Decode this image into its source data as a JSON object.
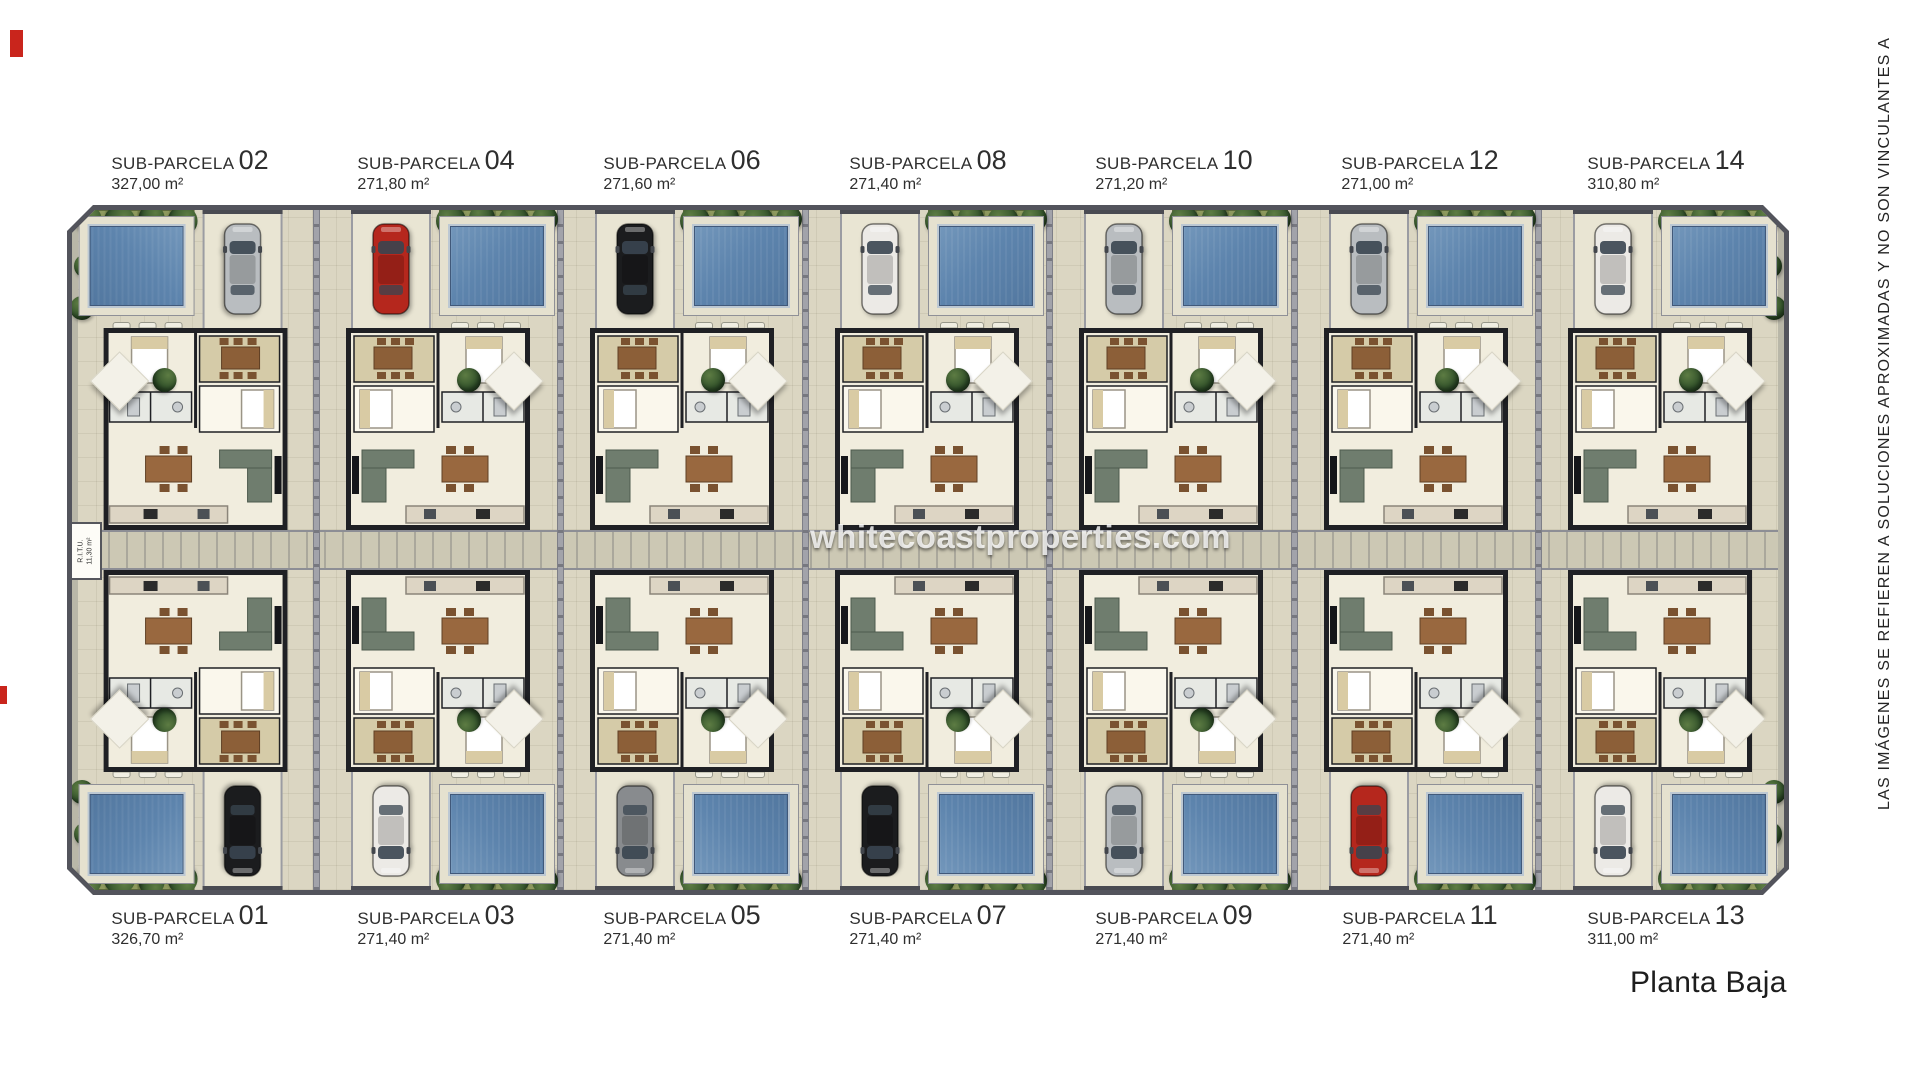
{
  "page": {
    "watermark": "whitecoastproperties.com",
    "plan_title": "Planta Baja",
    "side_disclaimer": "LAS IMÁGENES SE REFIEREN A SOLUCIONES APROXIMADAS Y NO SON VINCULANTES A",
    "ritu_label": "R.I.T.U.",
    "ritu_area": "11,30 m²"
  },
  "colors": {
    "ground": "#dbd6c2",
    "plan_border": "#53545c",
    "pool": "#5d84ad",
    "deck": "#e5e1cf",
    "tree": "#31512a",
    "villa_wall": "#1f2024",
    "villa_floor": "#f1edde",
    "lane": "#a2a3aa",
    "central_band": "#ccc8b4",
    "red_mark": "#c9251c",
    "car_colors": {
      "silver": "#b9bdc0",
      "red": "#b5271d",
      "black": "#1b1c1e",
      "white": "#eceae6",
      "gray": "#888b8e"
    }
  },
  "parcels": [
    {
      "label": "SUB-PARCELA",
      "number": "02",
      "area": "327,00 m²",
      "row": "top",
      "col": 0,
      "pool_side": "left",
      "car_color": "silver"
    },
    {
      "label": "SUB-PARCELA",
      "number": "04",
      "area": "271,80 m²",
      "row": "top",
      "col": 1,
      "pool_side": "right",
      "car_color": "red"
    },
    {
      "label": "SUB-PARCELA",
      "number": "06",
      "area": "271,60 m²",
      "row": "top",
      "col": 2,
      "pool_side": "right",
      "car_color": "black"
    },
    {
      "label": "SUB-PARCELA",
      "number": "08",
      "area": "271,40 m²",
      "row": "top",
      "col": 3,
      "pool_side": "right",
      "car_color": "white"
    },
    {
      "label": "SUB-PARCELA",
      "number": "10",
      "area": "271,20 m²",
      "row": "top",
      "col": 4,
      "pool_side": "right",
      "car_color": "silver"
    },
    {
      "label": "SUB-PARCELA",
      "number": "12",
      "area": "271,00 m²",
      "row": "top",
      "col": 5,
      "pool_side": "right",
      "car_color": "silver"
    },
    {
      "label": "SUB-PARCELA",
      "number": "14",
      "area": "310,80 m²",
      "row": "top",
      "col": 6,
      "pool_side": "right",
      "car_color": "white"
    },
    {
      "label": "SUB-PARCELA",
      "number": "01",
      "area": "326,70 m²",
      "row": "bottom",
      "col": 0,
      "pool_side": "left",
      "car_color": "black"
    },
    {
      "label": "SUB-PARCELA",
      "number": "03",
      "area": "271,40 m²",
      "row": "bottom",
      "col": 1,
      "pool_side": "right",
      "car_color": "white"
    },
    {
      "label": "SUB-PARCELA",
      "number": "05",
      "area": "271,40 m²",
      "row": "bottom",
      "col": 2,
      "pool_side": "right",
      "car_color": "gray"
    },
    {
      "label": "SUB-PARCELA",
      "number": "07",
      "area": "271,40 m²",
      "row": "bottom",
      "col": 3,
      "pool_side": "right",
      "car_color": "black"
    },
    {
      "label": "SUB-PARCELA",
      "number": "09",
      "area": "271,40 m²",
      "row": "bottom",
      "col": 4,
      "pool_side": "right",
      "car_color": "silver"
    },
    {
      "label": "SUB-PARCELA",
      "number": "11",
      "area": "271,40 m²",
      "row": "bottom",
      "col": 5,
      "pool_side": "right",
      "car_color": "red"
    },
    {
      "label": "SUB-PARCELA",
      "number": "13",
      "area": "311,00 m²",
      "row": "bottom",
      "col": 6,
      "pool_side": "right",
      "car_color": "white"
    }
  ]
}
